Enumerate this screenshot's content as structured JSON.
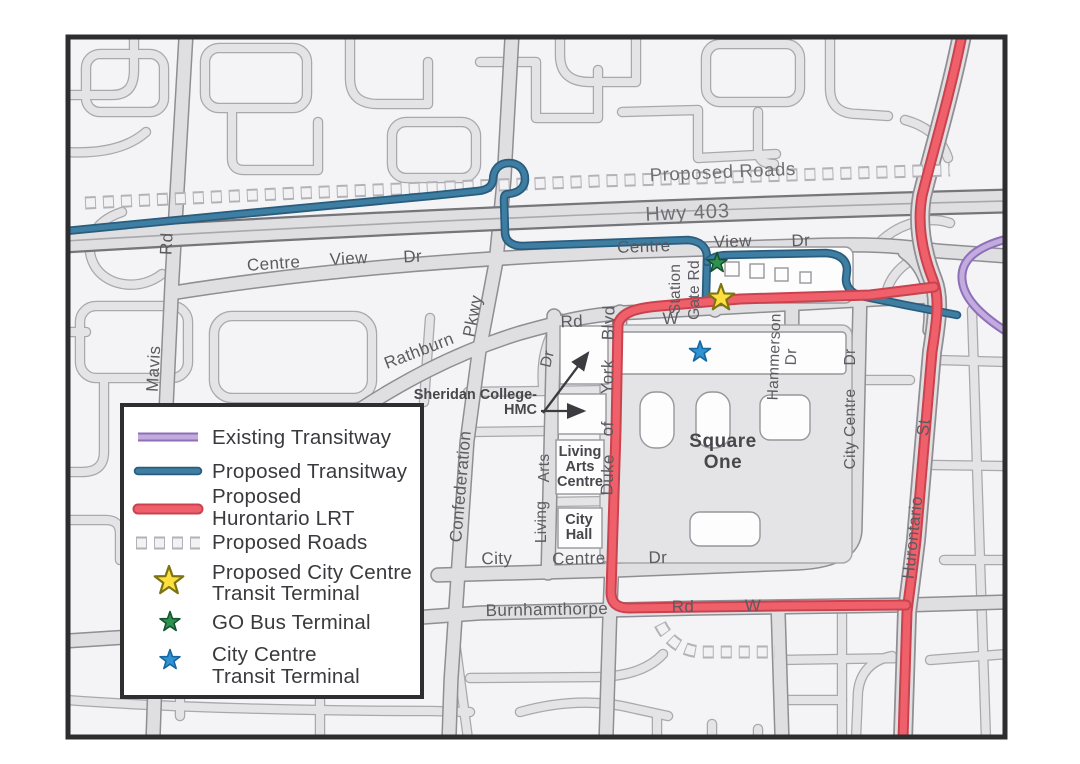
{
  "map": {
    "labels": {
      "proposed_roads": "Proposed Roads",
      "hwy_403": "Hwy 403",
      "mavis": "Mavis",
      "mavis_rd": "Rd",
      "centre_view_w": {
        "centre": "Centre",
        "view": "View",
        "dr": "Dr"
      },
      "centre_view_e": {
        "centre": "Centre",
        "view": "View",
        "dr": "Dr"
      },
      "pkwy": "Pkwy",
      "rathburn": "Rathburn",
      "rathburn_rd": "Rd",
      "rathburn_w": "W",
      "confederation": "Confederation",
      "station": "Station",
      "gate_rd": "Gate Rd",
      "duke": "Duke",
      "of": "of",
      "york": "York",
      "blvd": "Blvd",
      "hammerson": "Hammerson",
      "hammerson_dr": "Dr",
      "city_centre_vertical": "City Centre",
      "city_centre_vertical_dr": "Dr",
      "living": "Living",
      "arts": "Arts",
      "living_arts_dr": "Dr",
      "city_centre_city": "City",
      "city_centre_centre": "Centre",
      "city_centre_dr": "Dr",
      "burnhamthorpe": "Burnhamthorpe",
      "burnhamthorpe_rd": "Rd",
      "burnhamthorpe_w": "W",
      "hurontario": "Hurontario",
      "hurontario_st": "St",
      "square_one_line1": "Square",
      "square_one_line2": "One",
      "living_arts_centre_line1": "Living",
      "living_arts_centre_line2": "Arts",
      "living_arts_centre_line3": "Centre",
      "city_hall_line1": "City",
      "city_hall_line2": "Hall",
      "sheridan_line1": "Sheridan College-",
      "sheridan_line2": "HMC"
    },
    "markers": {
      "proposed_terminal": "Proposed City Centre Transit Terminal",
      "go_bus_terminal": "GO Bus Terminal",
      "city_centre_terminal": "City Centre Transit Terminal"
    }
  },
  "colors": {
    "existing_transitway": "#c2abdd",
    "proposed_transitway": "#3e7ea3",
    "proposed_lrt": "#f0606b",
    "proposed_roads_dash": "#f2f2f4",
    "terminal_star_yellow": "#ffdf3d",
    "go_star_green": "#2f9150",
    "city_centre_star_blue": "#2f93d4"
  },
  "legend": {
    "items": [
      {
        "type": "line",
        "line1": "Existing Transitway",
        "line2": ""
      },
      {
        "type": "line",
        "line1": "Proposed Transitway",
        "line2": ""
      },
      {
        "type": "line",
        "line1": "Proposed",
        "line2": "Hurontario LRT"
      },
      {
        "type": "dash",
        "line1": "Proposed Roads",
        "line2": ""
      },
      {
        "type": "star",
        "line1": "Proposed City Centre",
        "line2": "Transit Terminal"
      },
      {
        "type": "star",
        "line1": "GO Bus Terminal",
        "line2": ""
      },
      {
        "type": "star",
        "line1": "City Centre",
        "line2": "Transit Terminal"
      }
    ]
  }
}
